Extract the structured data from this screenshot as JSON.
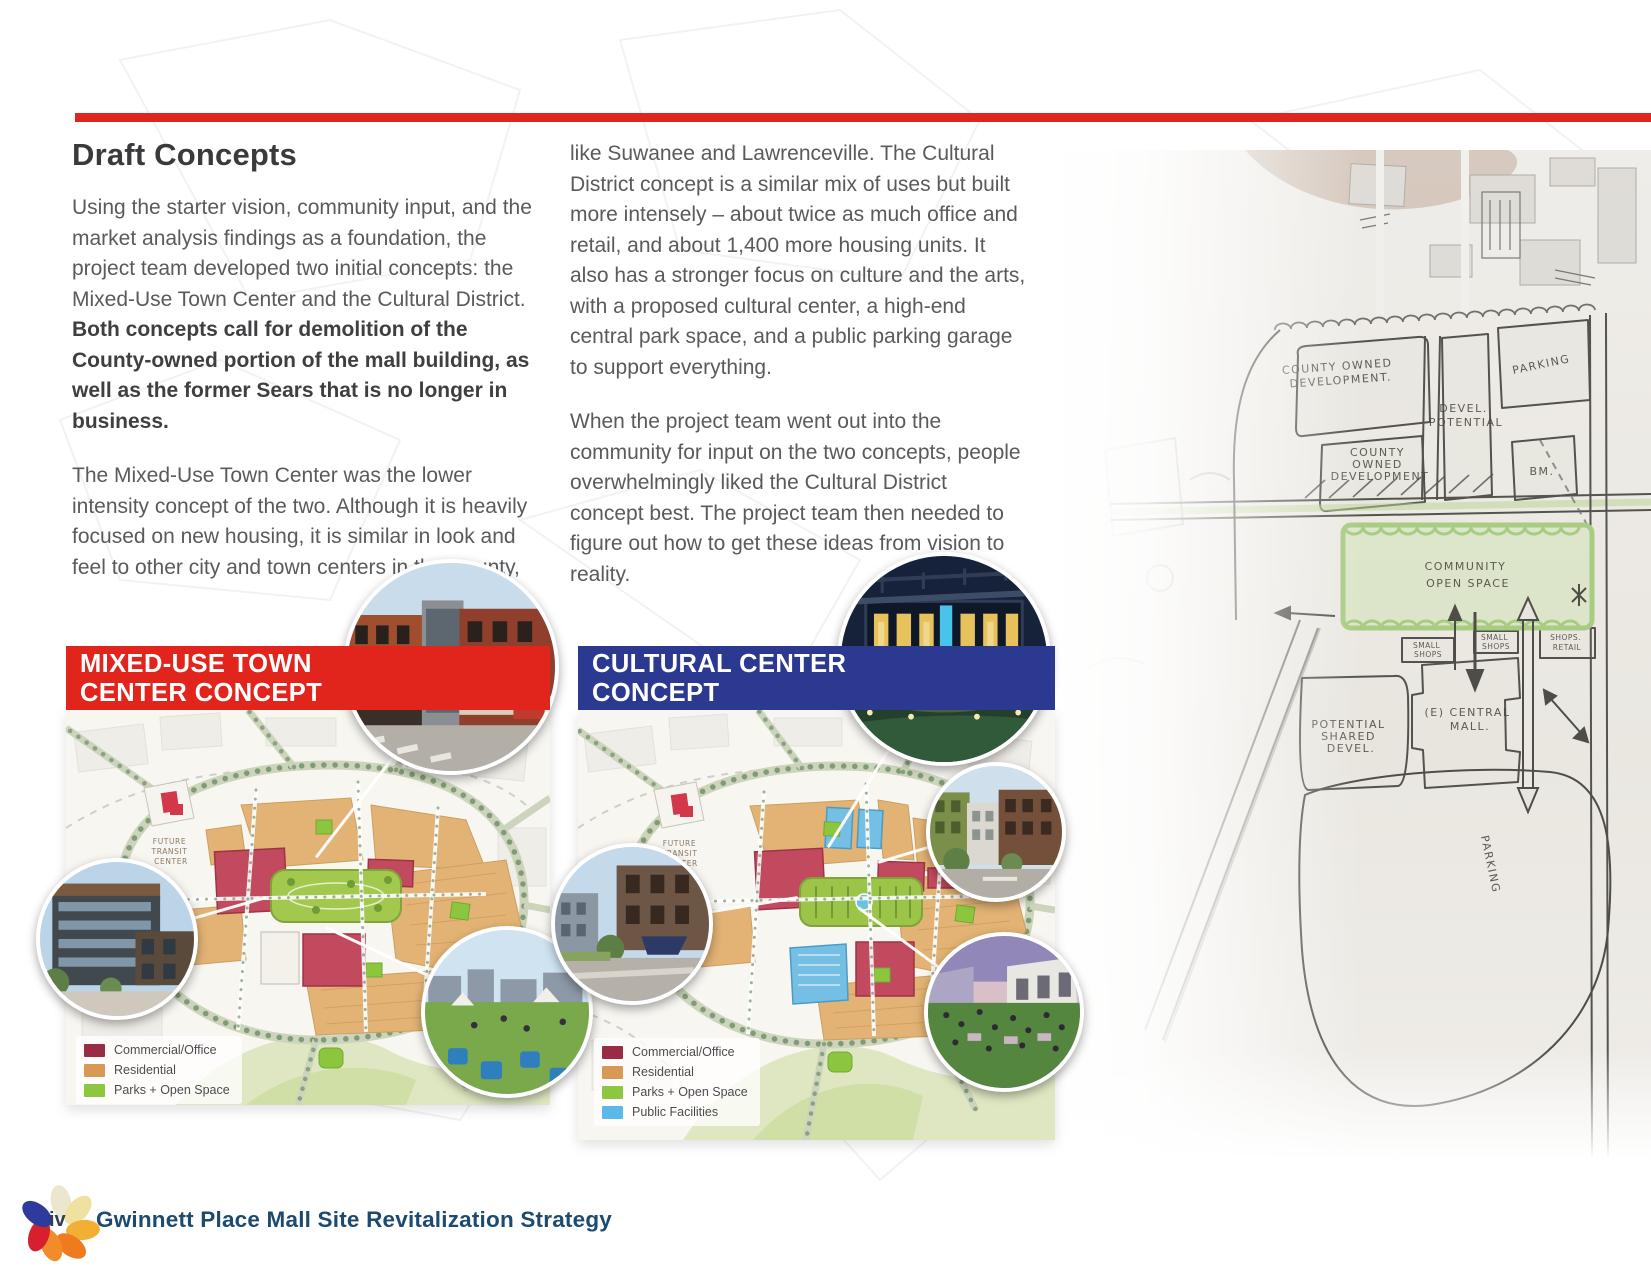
{
  "page": {
    "colors": {
      "rule_red": "#E0241F",
      "banner_red": "#E1251C",
      "banner_blue": "#2B3990",
      "footer_navy": "#1d4a70"
    },
    "footer": {
      "page_number": "iv",
      "title": "Gwinnett Place Mall Site Revitalization Strategy"
    }
  },
  "article": {
    "heading": "Draft Concepts",
    "col1_p1_normal": "Using the starter vision, community input, and the market analysis findings as a foundation, the project team developed two initial concepts: the Mixed-Use Town Center and the Cultural District. ",
    "col1_p1_bold": "Both concepts call for demolition of the County-owned portion of the mall building, as well as the former Sears that is no longer in business.",
    "col1_p2": "The Mixed-Use Town Center was the lower intensity concept of the two. Although it is heavily focused on new housing, it is similar in look and feel to other city and town centers in the County,",
    "col2_p1": "like Suwanee and Lawrenceville. The Cultural District concept is a similar mix of uses but built more intensely – about twice as much office and retail, and about 1,400 more housing units. It also has a stronger focus on culture and the arts, with a proposed cultural center, a high-end central park space, and a public parking garage to support everything.",
    "col2_p2": "When the project team went out into the community for input on the two concepts, people overwhelmingly liked the Cultural District concept best.  The project team then needed to figure out how to get these ideas from vision to reality."
  },
  "site_map": {
    "annotation_lines": [
      "FUTURE",
      "TRANSIT",
      "CENTER"
    ]
  },
  "concepts": {
    "mixed_use": {
      "banner": "MIXED-USE TOWN CENTER CONCEPT",
      "banner_color": "#E1251C",
      "legend": [
        {
          "label": "Commercial/Office",
          "color": "#9A2B44"
        },
        {
          "label": "Residential",
          "color": "#D79A55"
        },
        {
          "label": "Parks + Open Space",
          "color": "#8DC63F"
        }
      ]
    },
    "cultural": {
      "banner": "CULTURAL CENTER CONCEPT",
      "banner_color": "#2B3990",
      "legend": [
        {
          "label": "Commercial/Office",
          "color": "#9A2B44"
        },
        {
          "label": "Residential",
          "color": "#D79A55"
        },
        {
          "label": "Parks + Open Space",
          "color": "#8DC63F"
        },
        {
          "label": "Public Facilities",
          "color": "#5CB8E8"
        }
      ]
    }
  },
  "sketch": {
    "labels": {
      "county_owned_1": [
        "COUNTY OWNED",
        "DEVELOPMENT."
      ],
      "parking_upper": [
        "PARKING"
      ],
      "devel_potential": [
        "DEVEL.",
        "POTENTIAL"
      ],
      "county_owned_2": [
        "COUNTY",
        "OWNED",
        "DEVELOPMENT"
      ],
      "bm_parcel": [
        "BM."
      ],
      "community_open_space": [
        "COMMUNITY",
        "OPEN SPACE"
      ],
      "small_shops_1": [
        "SMALL",
        "SHOPS"
      ],
      "small_shops_2": [
        "SMALL",
        "SHOPS"
      ],
      "shops_retail": [
        "SHOPS.",
        "RETAIL"
      ],
      "potential_shared": [
        "POTENTIAL",
        "SHARED",
        "DEVEL."
      ],
      "central_mall": [
        "(E) CENTRAL",
        "MALL."
      ],
      "parking_lower": [
        "PARKING"
      ]
    }
  }
}
